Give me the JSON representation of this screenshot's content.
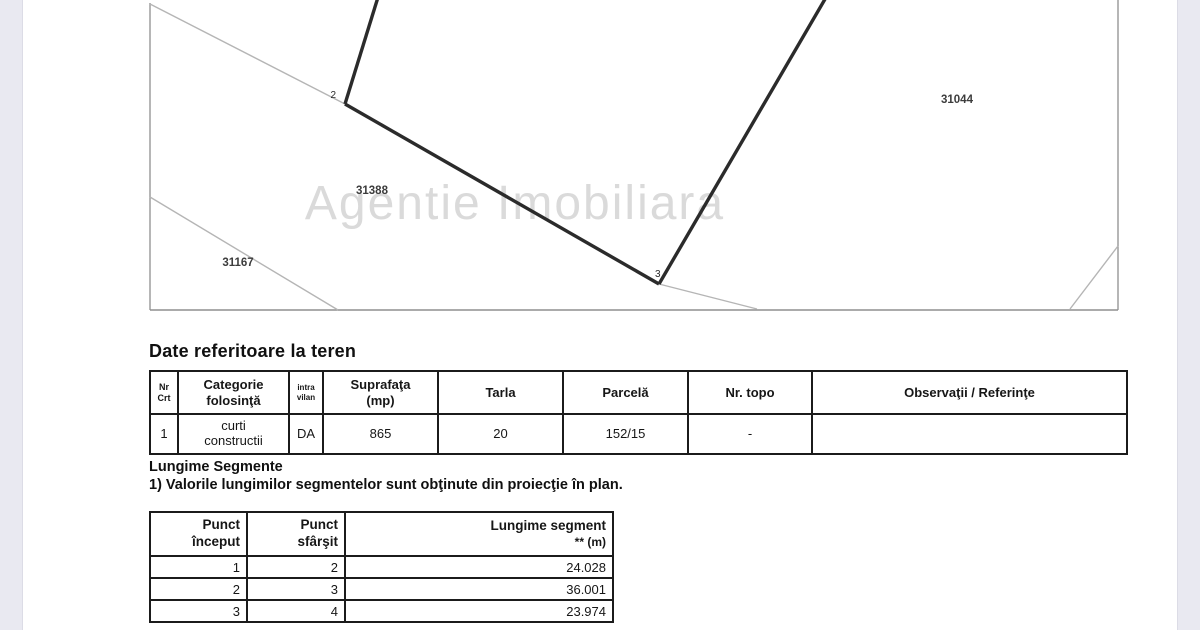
{
  "map": {
    "watermark": "Agentie Imobiliara",
    "parcel_labels": [
      "31388",
      "31167",
      "31044"
    ],
    "point_labels": [
      "2",
      "3"
    ],
    "colors": {
      "boundary_thin": "#b5b5b5",
      "boundary_thick": "#2b2b2b",
      "frame": "#8f8f8f",
      "watermark": "#dadada"
    }
  },
  "teren": {
    "title": "Date referitoare la teren",
    "table": {
      "headers": [
        "Nr\nCrt",
        "Categorie\nfolosinţă",
        "intra\nvilan",
        "Suprafaţa\n(mp)",
        "Tarla",
        "Parcelă",
        "Nr. topo",
        "Observaţii / Referinţe"
      ],
      "row": [
        "1",
        "curti\nconstructii",
        "DA",
        "865",
        "20",
        "152/15",
        "-",
        ""
      ]
    }
  },
  "segments": {
    "title": "Lungime Segmente",
    "note": "1) Valorile lungimilor segmentelor sunt obţinute din proiecţie în plan.",
    "table": {
      "headers": [
        {
          "top": "Punct",
          "bottom": "început"
        },
        {
          "top": "Punct",
          "bottom": "sfârşit"
        },
        {
          "top": "Lungime segment",
          "bottom": "** (m)"
        }
      ],
      "rows": [
        [
          "1",
          "2",
          "24.028"
        ],
        [
          "2",
          "3",
          "36.001"
        ],
        [
          "3",
          "4",
          "23.974"
        ]
      ]
    }
  }
}
